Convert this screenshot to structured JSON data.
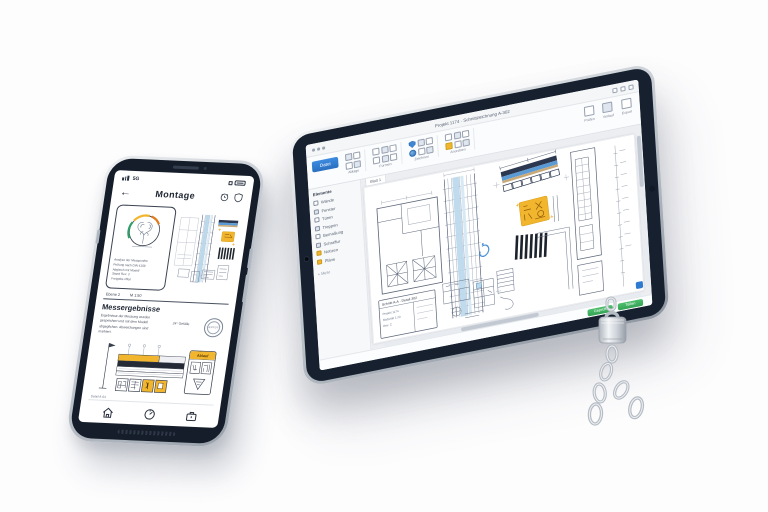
{
  "colors": {
    "accent_blue": "#2f7ad1",
    "highlight_yellow": "#f2b52e",
    "success_green": "#41b061",
    "bezel_dark": "#17202e",
    "drawing_line": "#5b6578"
  },
  "phone": {
    "status": {
      "carrier": "5G"
    },
    "nav": {
      "back_glyph": "←",
      "title": "Montage"
    },
    "report_card": {
      "lines": [
        "Analyse der Messpunkte",
        "Prüfung nach DIN 4109",
        "Abgleich mit Modell",
        "Stand Rev. 3",
        "Freigabe offen"
      ]
    },
    "meta_row": {
      "left": "Ebene 2",
      "right": "M 1:50"
    },
    "results": {
      "heading": "Messergebnisse",
      "body_lines": [
        "Ergebnisse der Messung wurden",
        "gespeichert und mit dem Modell",
        "abgeglichen. Abweichungen sind",
        "markiert."
      ],
      "side_note": "24° Gefälle",
      "stamp_text": "GEPRÜFT"
    },
    "diagram": {
      "card_header": "Ablauf",
      "caption": "Detail A-04"
    }
  },
  "tablet": {
    "titlebar": {
      "title": "Projekt 1174 · Schnittzeichnung A-302"
    },
    "ribbon": {
      "file_label": "Datei",
      "groups": [
        {
          "label": "Ablage"
        },
        {
          "label": "Formen"
        },
        {
          "label": "Zeichnen"
        },
        {
          "label": "Anordnen"
        }
      ],
      "right_groups": [
        {
          "label": "Prüfen"
        },
        {
          "label": "Verlauf"
        },
        {
          "label": "Export"
        }
      ]
    },
    "page_tab": "Blatt 1",
    "sidebar": {
      "title": "Elemente",
      "items": [
        {
          "label": "Wände"
        },
        {
          "label": "Fenster"
        },
        {
          "label": "Türen"
        },
        {
          "label": "Treppen"
        },
        {
          "label": "Bemaßung"
        },
        {
          "label": "Schraffur"
        },
        {
          "label": "Notizen"
        },
        {
          "label": "Pläne"
        }
      ],
      "more_label": "+ Mehr"
    },
    "canvas": {
      "title_block": {
        "heading": "Schnitt A-A · Detail 302",
        "lines": [
          "Projekt 1174",
          "Maßstab 1:20",
          "Rev. C"
        ]
      }
    },
    "statusbar": {
      "buttons": [
        {
          "label": "Geprüft"
        },
        {
          "label": "Teilen"
        }
      ]
    }
  }
}
